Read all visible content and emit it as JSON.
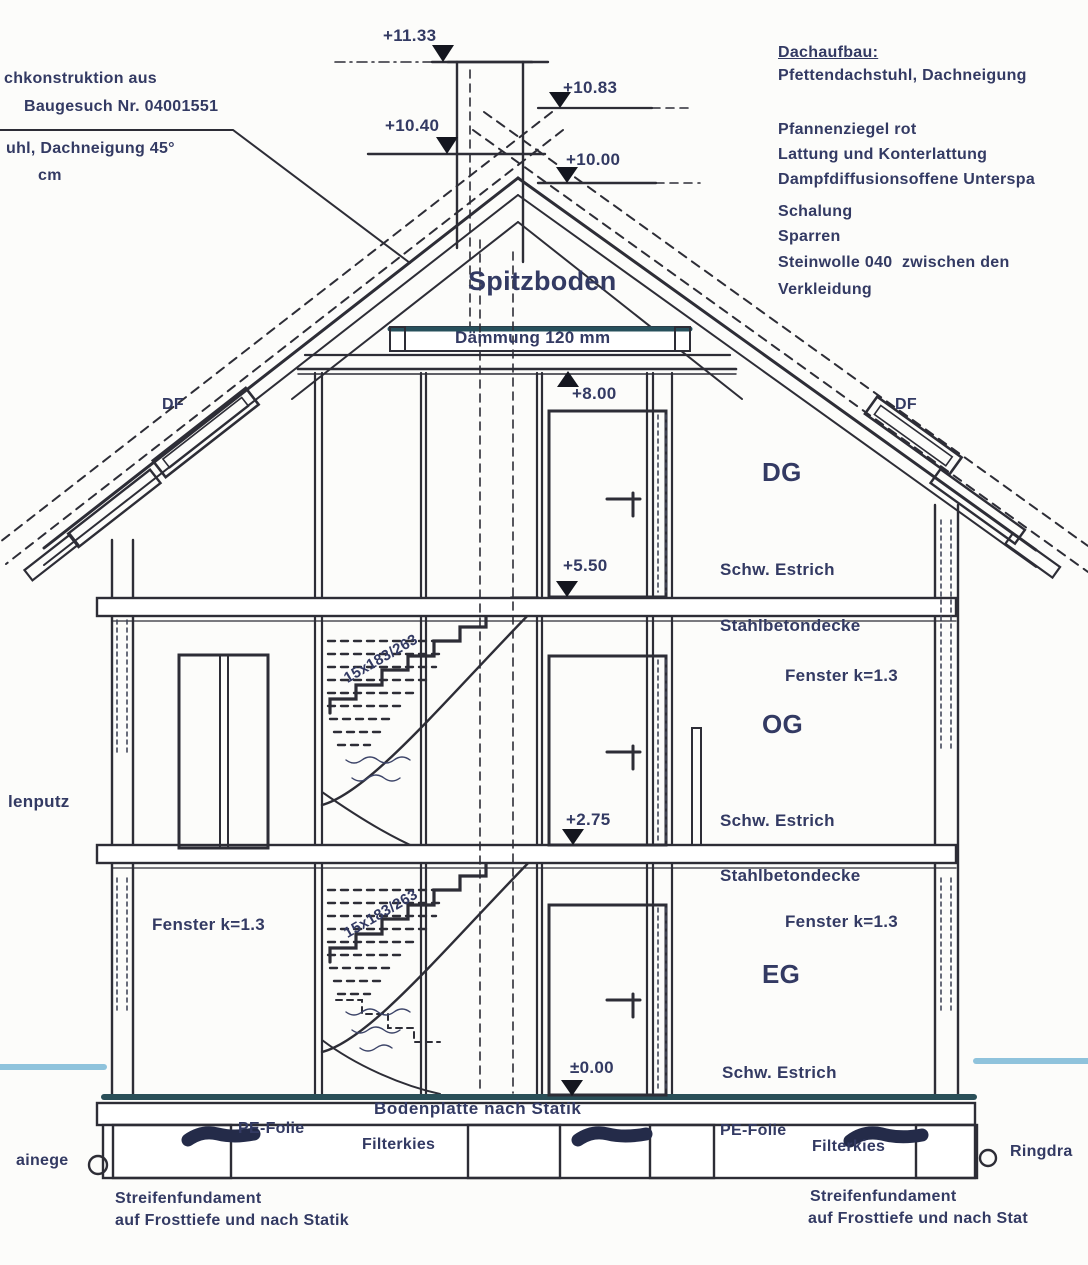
{
  "notes_top_left": {
    "line1": "chkonstruktion aus",
    "line2": "Baugesuch Nr. 04001551",
    "line3": "uhl, Dachneigung 45°",
    "line4": "cm"
  },
  "roof_spec": {
    "title": "Dachaufbau:",
    "system": "Pfettendachstuhl, Dachneigung",
    "materials": [
      "Pfannenziegel rot",
      "Lattung und Konterlattung",
      "Dampfdiffusionsoffene Unterspa",
      "Schalung",
      "Sparren",
      "Steinwolle 040  zwischen den",
      "Verkleidung"
    ]
  },
  "elevations": {
    "chimney_top": "+11.33",
    "ridge": "+10.83",
    "chimney_shoulder": "+10.40",
    "ridge_lower": "+10.00",
    "spitzboden_floor": "+8.00",
    "dg_floor": "+5.50",
    "og_floor": "+2.75",
    "eg_floor": "±0.00"
  },
  "rooms": {
    "spitzboden": "Spitzboden",
    "dg": "DG",
    "og": "OG",
    "eg": "EG"
  },
  "roof_windows": {
    "left": "DF",
    "right": "DF"
  },
  "floors": {
    "daemmung": "Dämmung 120 mm",
    "estrich_dg": "Schw. Estrich",
    "decke_dg": "Stahlbetondecke",
    "estrich_og": "Schw. Estrich",
    "decke_og": "Stahlbetondecke",
    "estrich_eg": "Schw. Estrich"
  },
  "windows": {
    "og_right": "Fenster k=1.3",
    "eg_left": "Fenster k=1.3",
    "eg_right": "Fenster k=1.3"
  },
  "stairs": {
    "upper": "15x183/263",
    "lower": "15x183/263"
  },
  "facade": {
    "putz": "lenputz"
  },
  "foundation": {
    "bodenplatte": "Bodenplatte nach Statik",
    "pe_folie_left": "PE-Folie",
    "filterkies_left": "Filterkies",
    "pe_folie_right": "PE-Folie",
    "filterkies_right": "Filterkies",
    "streifen_left_line1": "Streifenfundament",
    "streifen_left_line2": "auf Frosttiefe und nach Statik",
    "streifen_right_line1": "Streifenfundament",
    "streifen_right_line2": "auf Frosttiefe und nach Stat",
    "drain_left": "ainege",
    "drain_right": "Ringdra"
  },
  "colors": {
    "ink": "#333a63",
    "line": "#2d2d36",
    "water_level": "#8fc3dc",
    "ground_slab": "#2a4f58"
  }
}
